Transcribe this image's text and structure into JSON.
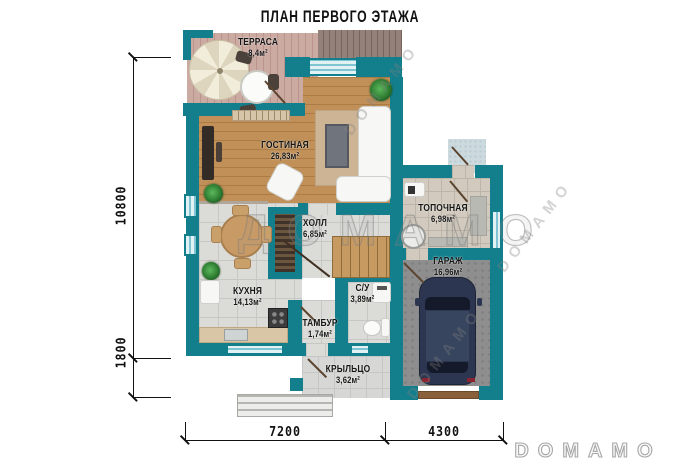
{
  "title": "ПЛАН ПЕРВОГО ЭТАЖА",
  "rooms": [
    {
      "name": "ТЕРРАСА",
      "area": "8,4м²"
    },
    {
      "name": "ГОСТИНАЯ",
      "area": "26,83м²"
    },
    {
      "name": "ХОЛЛ",
      "area": "6,85м²"
    },
    {
      "name": "ТОПОЧНАЯ",
      "area": "6,98м²"
    },
    {
      "name": "ГАРАЖ",
      "area": "16,96м²"
    },
    {
      "name": "КУХНЯ",
      "area": "14,13м²"
    },
    {
      "name": "С/У",
      "area": "3,89м²"
    },
    {
      "name": "ТАМБУР",
      "area": "1,74м²"
    },
    {
      "name": "КРЫЛЬЦО",
      "area": "3,62м²"
    }
  ],
  "dimensions": {
    "height_total": "10800",
    "height_lower": "1800",
    "width_left": "7200",
    "width_right": "4300"
  },
  "watermark": {
    "center": "ДОМАМО",
    "diagonal": "DOMAMO"
  },
  "logo": "DOMAMO",
  "colors": {
    "wall": "#137e8c",
    "wood": "#bb8d5c",
    "deck": "#c7a39c",
    "tile": "#dbdbd7",
    "tile_beige": "#d2cabe",
    "concrete": "#8e8e8e",
    "car": "#2c3650",
    "porch": "#d7d7d5"
  }
}
